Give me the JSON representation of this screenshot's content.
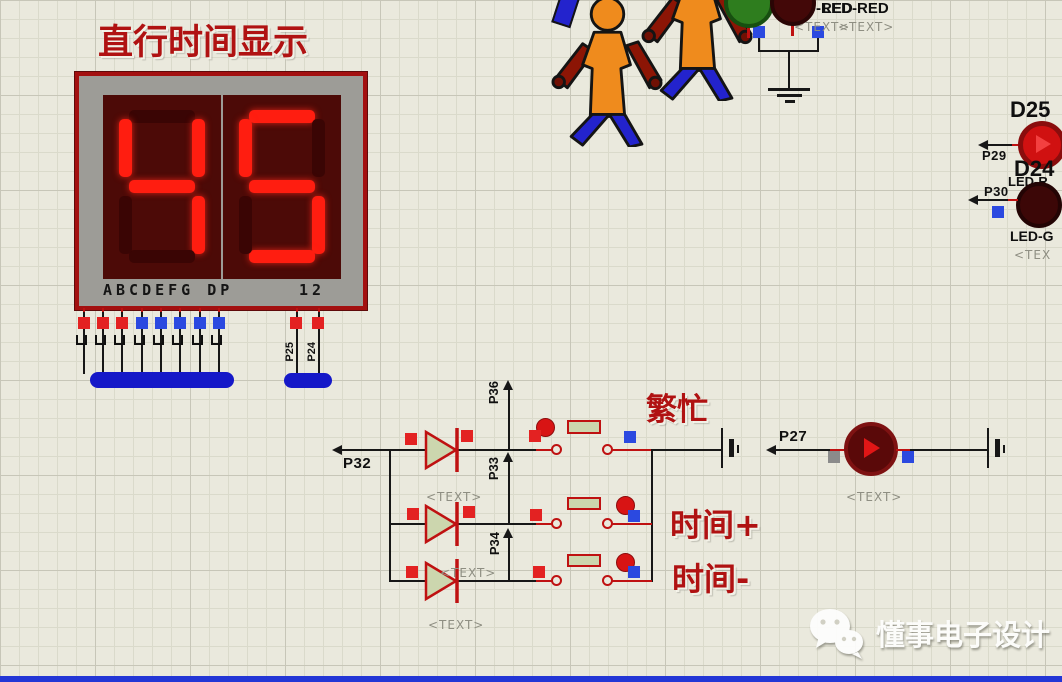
{
  "title": "直行时间显示",
  "display": {
    "digits": [
      "4",
      "5"
    ],
    "segment_map": {
      "4": [
        "f",
        "b",
        "g",
        "c"
      ],
      "5": [
        "a",
        "f",
        "g",
        "c",
        "d"
      ]
    },
    "pin_row_label": "ABCDEFG DP",
    "digit_index_label": "12"
  },
  "bus_pins": {
    "p25": "P25",
    "p24": "P24"
  },
  "net_labels": {
    "p32": "P32",
    "p33": "P33",
    "p34": "P34",
    "p36": "P36",
    "p27": "P27",
    "p29": "P29",
    "p30": "P30"
  },
  "annotations": {
    "busy": "繁忙",
    "time_plus": "时间+",
    "time_minus": "时间-",
    "placeholder": "<TEXT>"
  },
  "top_right": {
    "led_label_a": "LED-RED",
    "led_label_b": "LED-RED"
  },
  "right_edge": {
    "d25": "D25",
    "d24": "D24",
    "led_red_partial": "LED-R",
    "led_green_partial": "LED-G",
    "text_partial": "<TEX"
  },
  "watermark": {
    "text": "懂事电子设计"
  },
  "colors": {
    "wire": "#171717",
    "component_red": "#bf1111",
    "annotation_red": "#b01212",
    "segment_lit": "#ff1d10",
    "bus_blue": "#1518c8",
    "pin_blue": "#2b49e0",
    "pin_red": "#e32222",
    "canvas": "#eae9dd"
  }
}
